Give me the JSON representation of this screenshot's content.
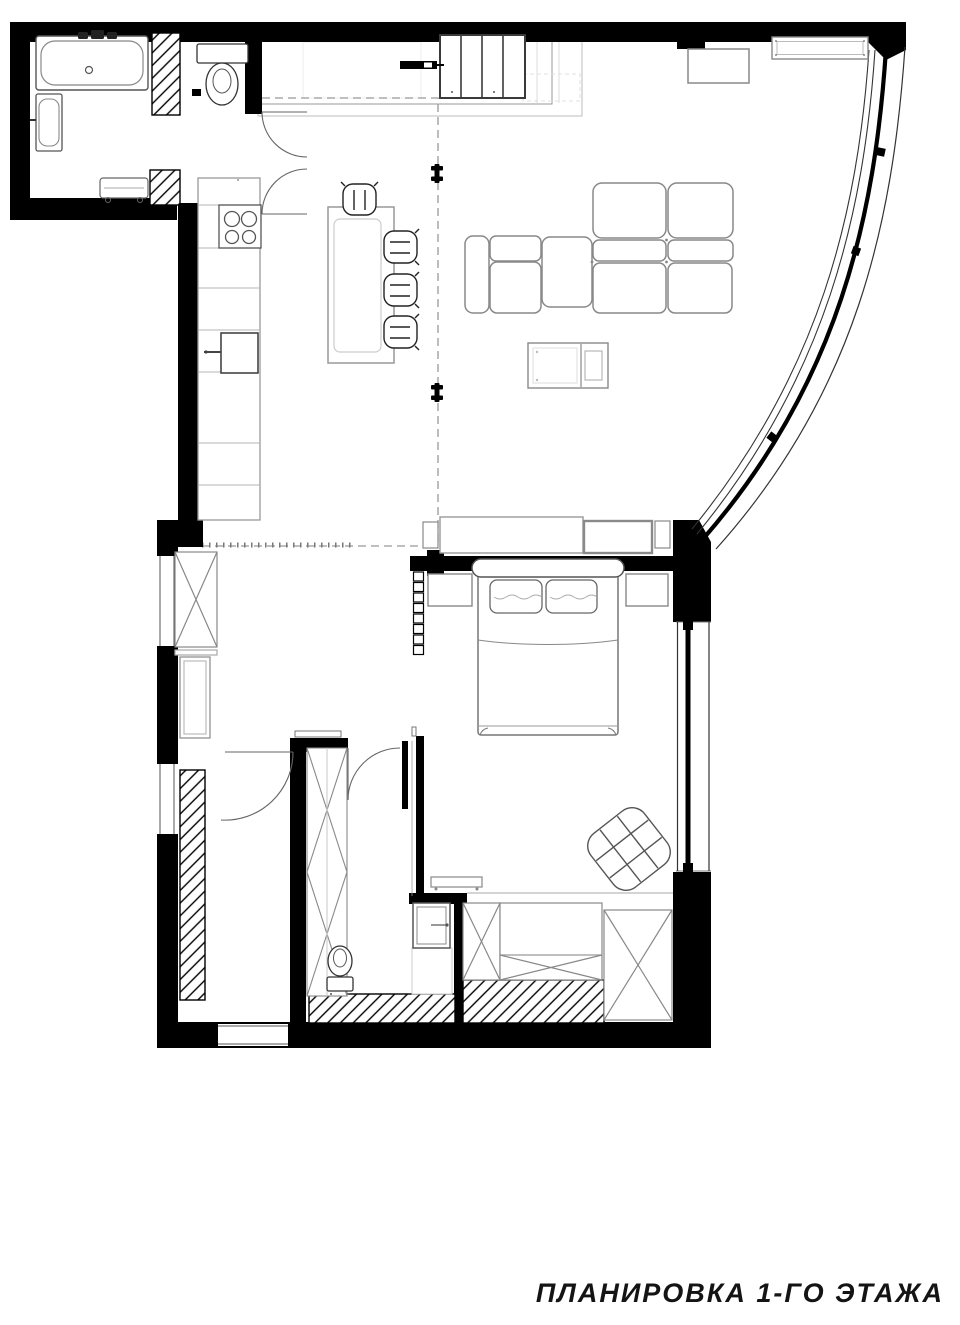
{
  "title": {
    "text": "ПЛАНИРОВКА 1-ГО ЭТАЖА"
  },
  "colors": {
    "walls": "#000000",
    "background": "#ffffff",
    "furniture_outline": "#888888",
    "dark_outline": "#3a3a3a",
    "ghost_outline": "#c0c0c0",
    "dashed_line": "#999999",
    "hatch": "#000000"
  },
  "symbols": [
    "bathtub-icon",
    "bath-sink-icon",
    "toilet-icon",
    "radiator-icon",
    "entry-wardrobe-icon",
    "kitchen-counter-icon",
    "cooktop-icon",
    "oven-icon",
    "dining-table-icon",
    "bar-chair-icon",
    "sofa-icon",
    "coffee-table-icon",
    "console-icon",
    "wall-shelf-icon",
    "tv-sideboard-icon",
    "double-bed-icon",
    "pillow-icon",
    "nightstand-icon",
    "ladder-icon",
    "armchair-icon",
    "bench-icon",
    "x-wardrobe-icon",
    "wc-toilet-icon",
    "wc-sink-icon",
    "window-icon",
    "curved-glazing-icon",
    "door-swing-icon",
    "track-anchor-icon"
  ]
}
